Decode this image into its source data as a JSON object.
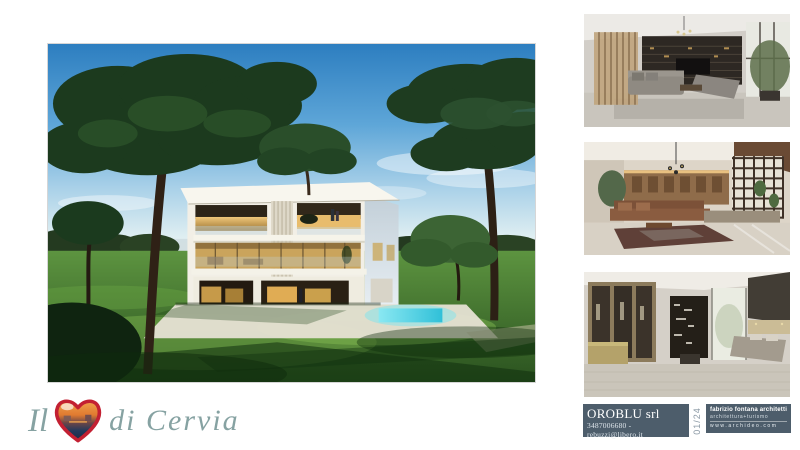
{
  "logo": {
    "word_start": "Il",
    "word_end": "di Cervia",
    "heart_icon": "heart-photo-icon",
    "script_color": "#86a2a2",
    "heart_red": "#c32032"
  },
  "main_image": {
    "label": "villa-exterior-render"
  },
  "gallery": {
    "items": [
      {
        "label": "interior-living-room-grey-render"
      },
      {
        "label": "interior-living-room-warm-render"
      },
      {
        "label": "interior-bedroom-render"
      }
    ]
  },
  "footer": {
    "company": {
      "name": "OROBLU srl",
      "contact": "3487006680 - rebuzzi@libero.it"
    },
    "page_number": "01/24",
    "architect": {
      "line1": "fabrizio fontana architetti",
      "line2": "architettura+turismo",
      "website": "www.archideo.com"
    },
    "block_color": "#4d5d6b"
  }
}
